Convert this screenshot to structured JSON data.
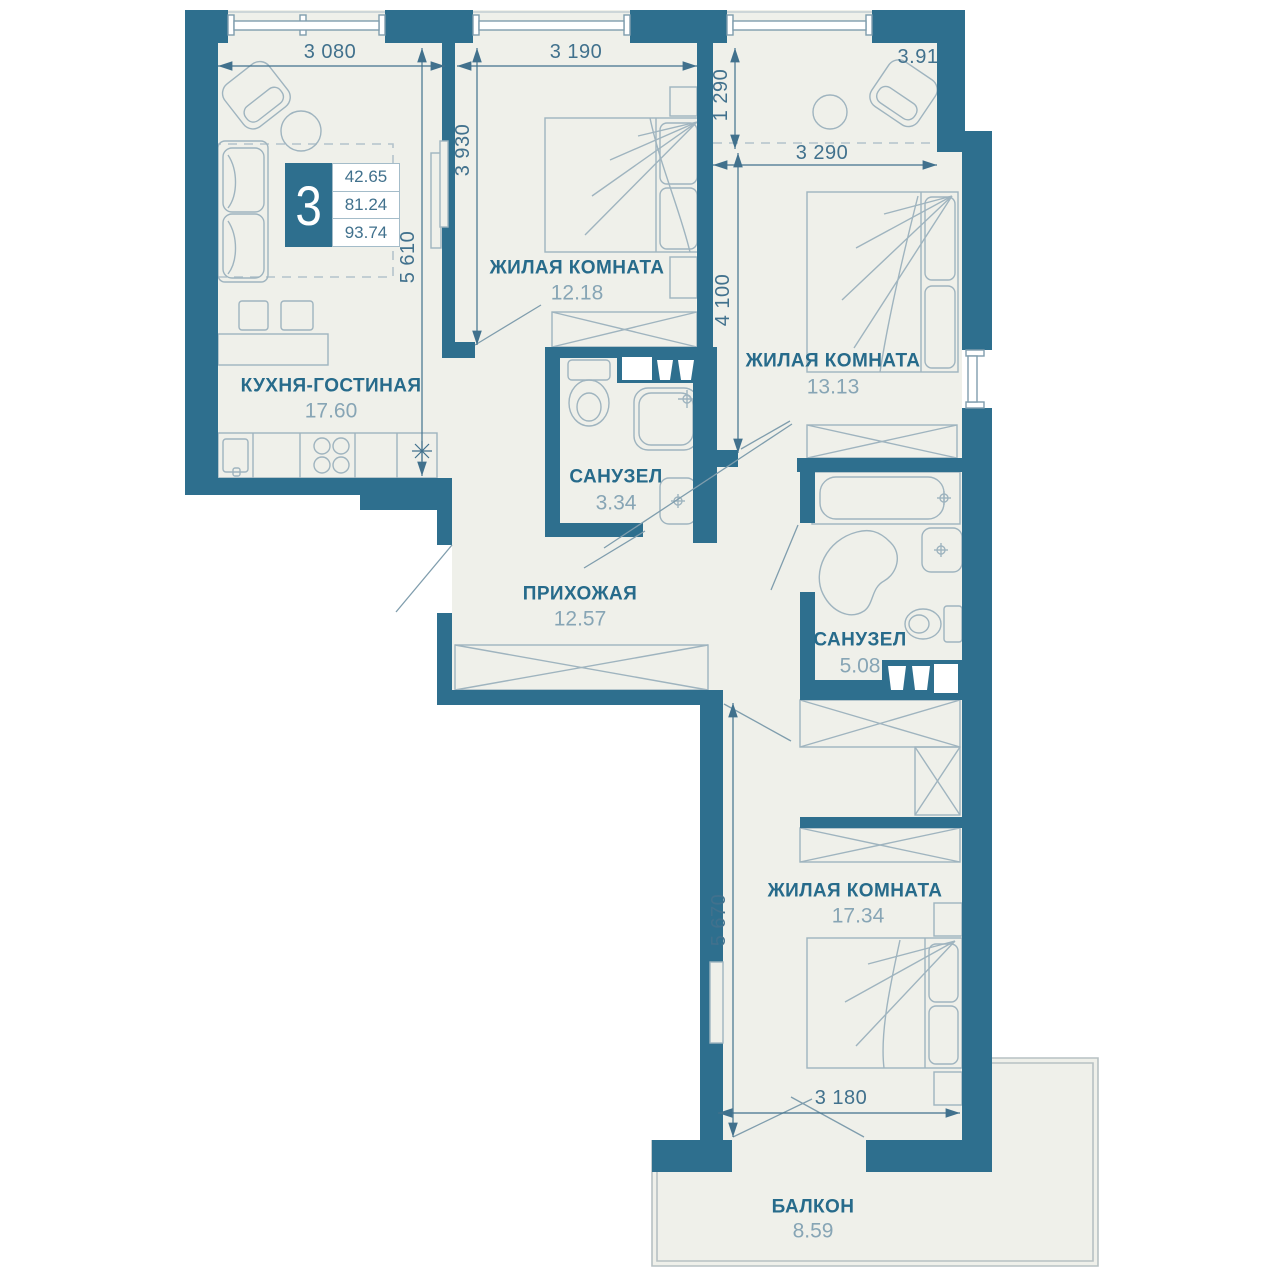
{
  "unit": {
    "rooms_count": "3",
    "areas": [
      "42.65",
      "81.24",
      "93.74"
    ]
  },
  "rooms": {
    "kitchen_living": {
      "name": "КУХНЯ-ГОСТИНАЯ",
      "area": "17.60"
    },
    "bedroom_top": {
      "name": "ЖИЛАЯ КОМНАТА",
      "area": "12.18"
    },
    "bedroom_right": {
      "name": "ЖИЛАЯ КОМНАТА",
      "area": "13.13"
    },
    "bathroom_small": {
      "name": "САНУЗЕЛ",
      "area": "3.34"
    },
    "hallway": {
      "name": "ПРИХОЖАЯ",
      "area": "12.57"
    },
    "bathroom_large": {
      "name": "САНУЗЕЛ",
      "area": "5.08"
    },
    "bedroom_bottom": {
      "name": "ЖИЛАЯ КОМНАТА",
      "area": "17.34"
    },
    "balcony": {
      "name": "БАЛКОН",
      "area": "8.59"
    }
  },
  "zone_area": "3.91",
  "dimensions": {
    "kitchen_width": "3 080",
    "bedroom_top_width": "3 190",
    "bedroom_top_height": "3 930",
    "kitchen_height": "5 610",
    "niche_height": "1 290",
    "bedroom_right_width": "3 290",
    "bedroom_right_height": "4 100",
    "bedroom_bottom_height": "5 670",
    "bedroom_bottom_width": "3 180"
  },
  "colors": {
    "wall": "#2e6f8e",
    "floor": "#eff0ea",
    "accent_text": "#276b8b",
    "dim_text": "#41718d"
  }
}
